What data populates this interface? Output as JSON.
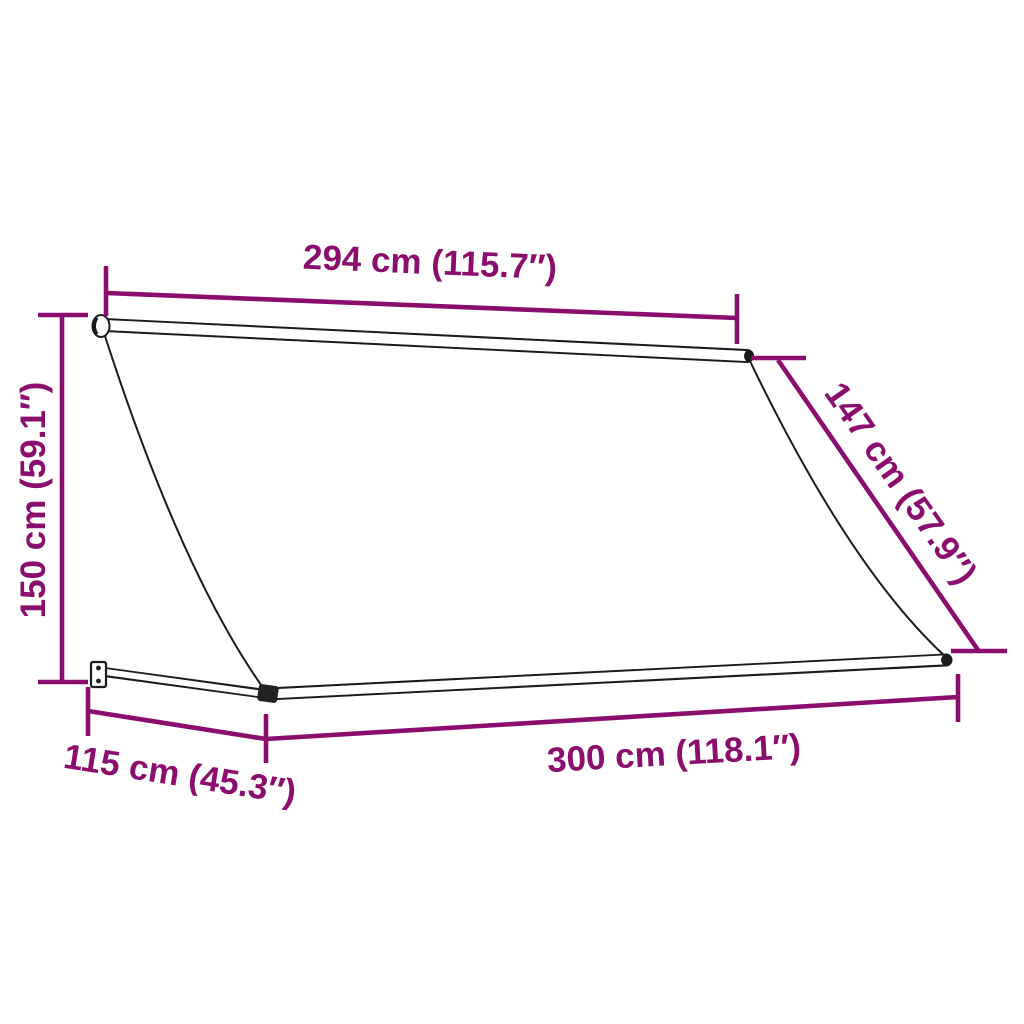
{
  "diagram": {
    "kind": "product-dimension-diagram",
    "product": "retractable-awning",
    "background_color": "#ffffff",
    "colors": {
      "dimension": "#8b0d6e",
      "outline": "#1b1b1b",
      "fill": "#ffffff"
    },
    "dimensions": {
      "back_width": "294 cm (115.7″)",
      "height": "150 cm (59.1″)",
      "side_slant": "147 cm (57.9″)",
      "projection_depth": "115 cm (45.3″)",
      "front_width": "300 cm (118.1″)"
    }
  }
}
